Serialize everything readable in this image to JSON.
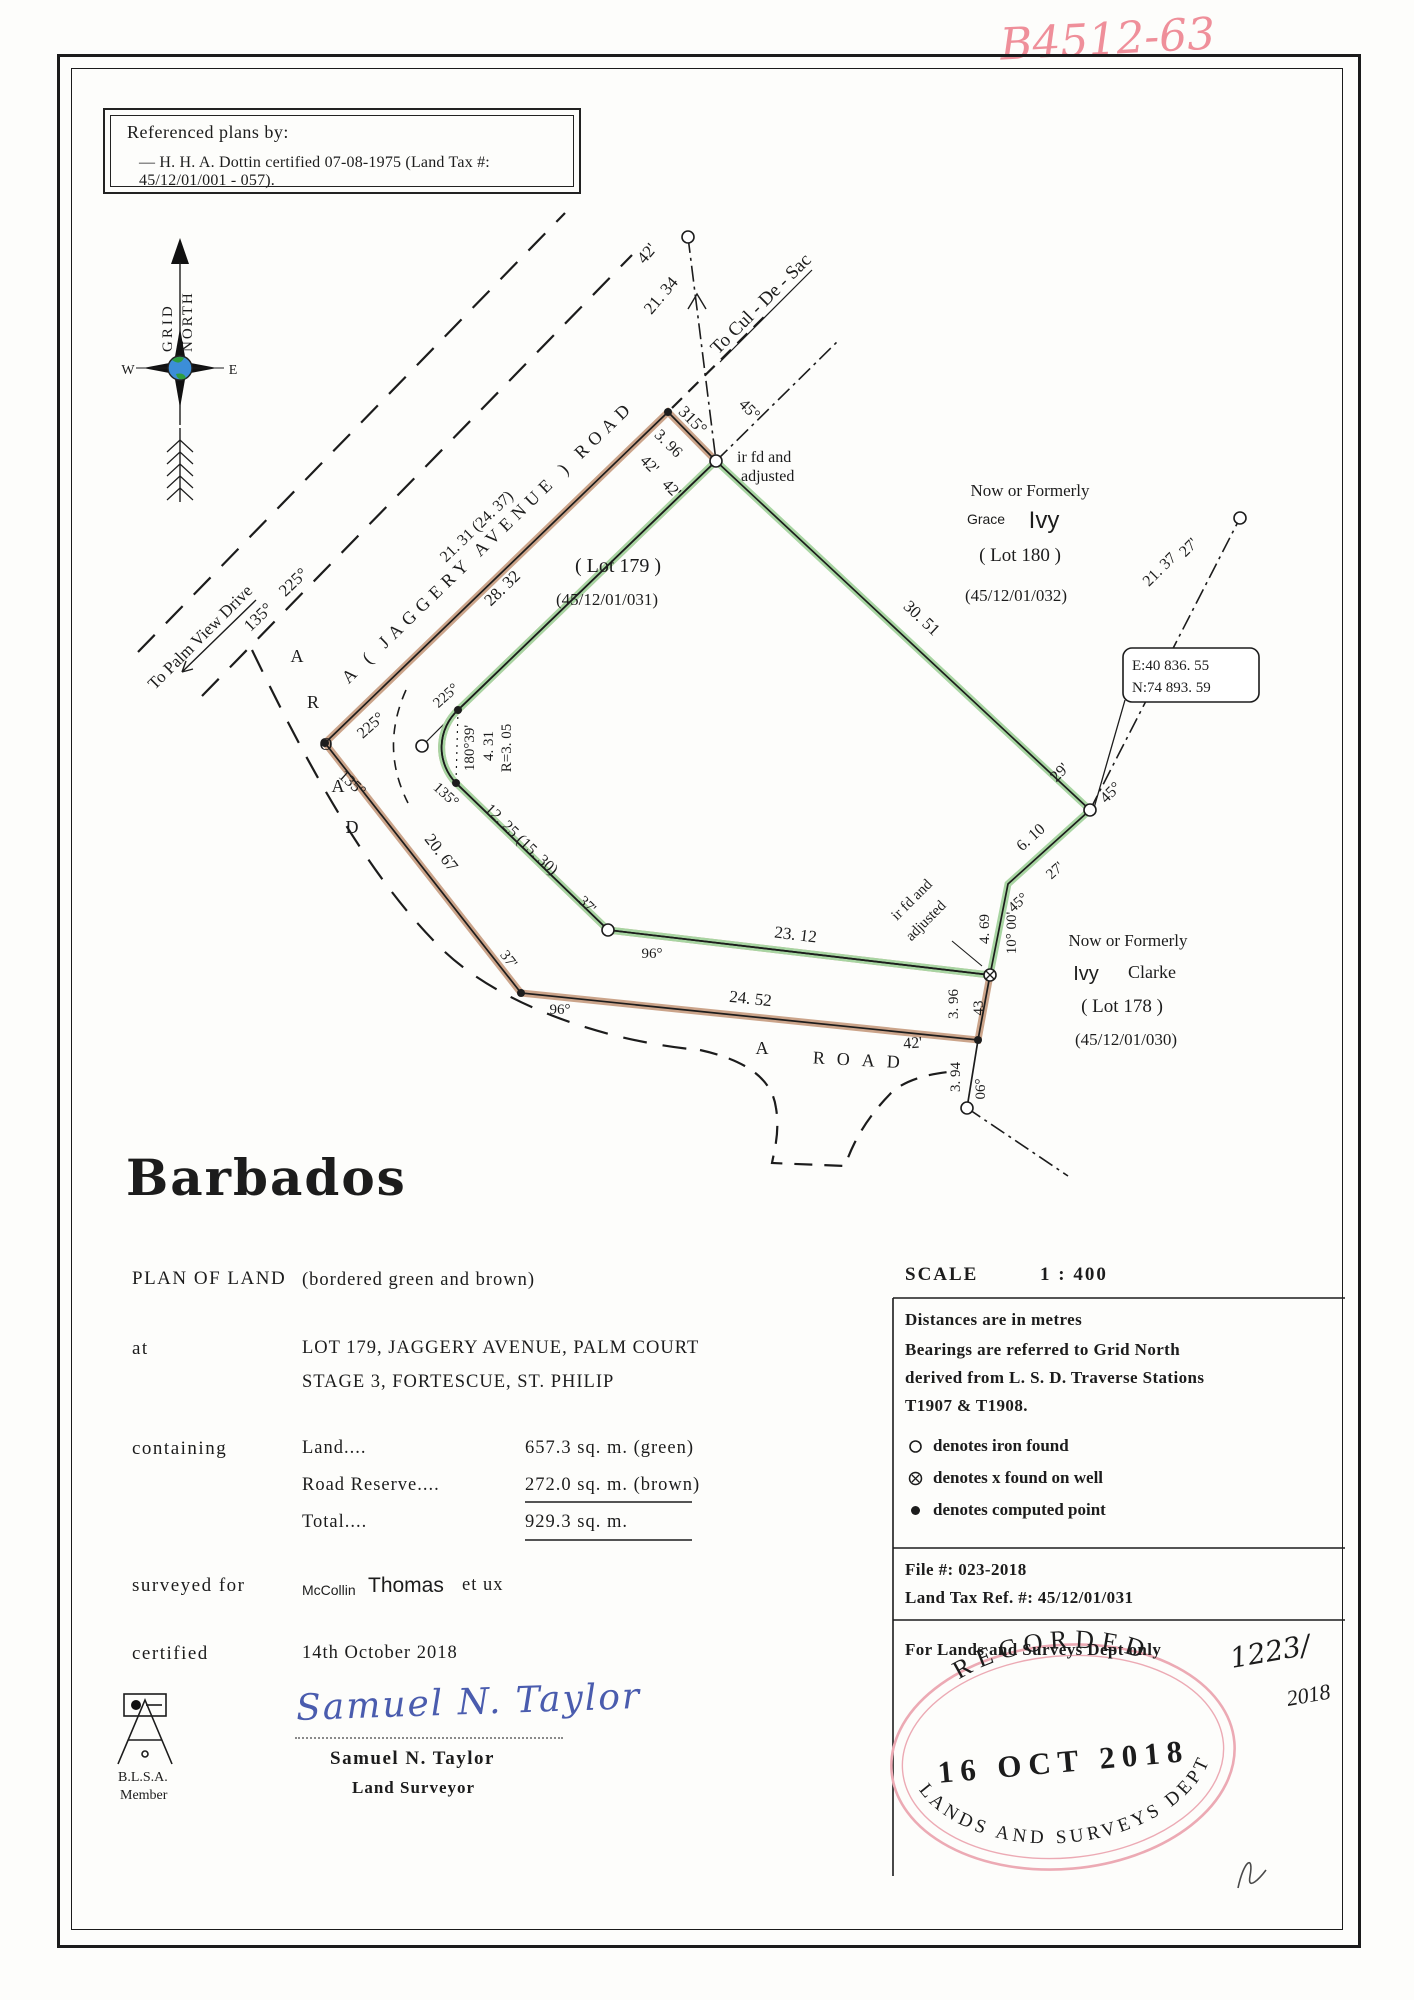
{
  "page": {
    "handwritten_ref": "B4512-63"
  },
  "referenced_plans": {
    "title": "Referenced plans by:",
    "item": "—   H. H. A. Dottin certified 07-08-1975 (Land Tax #: 45/12/01/001 - 057)."
  },
  "compass": {
    "grid": "GRID",
    "north": "NORTH",
    "w": "W",
    "e": "E"
  },
  "plan": {
    "coord_box": {
      "e": "E:40  836. 55",
      "n": "N:74  893. 59"
    },
    "labels": [
      {
        "t": "To Cul - De - Sac",
        "x": 765,
        "y": 308,
        "r": -45,
        "fs": 19
      },
      {
        "t": "42'",
        "x": 651,
        "y": 257,
        "r": -50,
        "fs": 17
      },
      {
        "t": "21. 34",
        "x": 665,
        "y": 299,
        "r": -50,
        "fs": 17
      },
      {
        "t": "45°",
        "x": 746,
        "y": 413,
        "r": 45,
        "fs": 16
      },
      {
        "t": "315°",
        "x": 689,
        "y": 424,
        "r": 45,
        "fs": 17
      },
      {
        "t": "3. 96",
        "x": 665,
        "y": 447,
        "r": 45,
        "fs": 16
      },
      {
        "t": "42'",
        "x": 646,
        "y": 468,
        "r": 45,
        "fs": 16
      },
      {
        "t": "42'",
        "x": 668,
        "y": 492,
        "r": 45,
        "fs": 16
      },
      {
        "t": "ir fd and",
        "x": 737,
        "y": 462,
        "r": 0,
        "fs": 16,
        "a": "start"
      },
      {
        "t": "adjusted",
        "x": 741,
        "y": 481,
        "r": 0,
        "fs": 16,
        "a": "start"
      },
      {
        "t": "Now or Formerly",
        "x": 1030,
        "y": 496,
        "r": 0,
        "fs": 17
      },
      {
        "t": "Grace",
        "x": 986,
        "y": 524,
        "r": 0,
        "fs": 14,
        "f": "sans"
      },
      {
        "t": "Ivy",
        "x": 1044,
        "y": 528,
        "r": 0,
        "fs": 24,
        "f": "sans"
      },
      {
        "t": "( Lot 180 )",
        "x": 1020,
        "y": 561,
        "r": 0,
        "fs": 19
      },
      {
        "t": "(45/12/01/032)",
        "x": 1016,
        "y": 601,
        "r": 0,
        "fs": 17
      },
      {
        "t": "A   ( JAGGERY  AVENUE )  ROAD",
        "x": 492,
        "y": 546,
        "r": -44,
        "fs": 18,
        "ls": 6
      },
      {
        "t": "28. 32",
        "x": 506,
        "y": 592,
        "r": -44,
        "fs": 17
      },
      {
        "t": "225°",
        "x": 297,
        "y": 586,
        "r": -44,
        "fs": 17
      },
      {
        "t": "135°",
        "x": 262,
        "y": 621,
        "r": -44,
        "fs": 17
      },
      {
        "t": "To Palm View Drive",
        "x": 204,
        "y": 641,
        "r": -45,
        "fs": 17
      },
      {
        "t": "225°",
        "x": 374,
        "y": 729,
        "r": -42,
        "fs": 16
      },
      {
        "t": "135°",
        "x": 349,
        "y": 787,
        "r": 42,
        "fs": 16
      },
      {
        "t": "A",
        "x": 297,
        "y": 662,
        "r": 0,
        "fs": 18
      },
      {
        "t": "R",
        "x": 313,
        "y": 708,
        "r": 0,
        "fs": 18
      },
      {
        "t": "O",
        "x": 326,
        "y": 750,
        "r": 0,
        "fs": 18
      },
      {
        "t": "A",
        "x": 338,
        "y": 792,
        "r": 0,
        "fs": 18
      },
      {
        "t": "D",
        "x": 352,
        "y": 833,
        "r": 0,
        "fs": 18
      },
      {
        "t": "20. 67",
        "x": 437,
        "y": 856,
        "r": 52,
        "fs": 17
      },
      {
        "t": "225°",
        "x": 449,
        "y": 699,
        "r": -42,
        "fs": 15
      },
      {
        "t": "135°",
        "x": 443,
        "y": 798,
        "r": 42,
        "fs": 15
      },
      {
        "t": "180°39'",
        "x": 474,
        "y": 748,
        "r": -90,
        "fs": 15
      },
      {
        "t": "4. 31",
        "x": 493,
        "y": 746,
        "r": -90,
        "fs": 15
      },
      {
        "t": "R=3. 05",
        "x": 511,
        "y": 748,
        "r": -90,
        "fs": 15
      },
      {
        "t": "21. 31  (24. 37)",
        "x": 480,
        "y": 530,
        "r": -44,
        "fs": 16
      },
      {
        "t": "12. 25  (15. 30)",
        "x": 518,
        "y": 843,
        "r": 44,
        "fs": 16
      },
      {
        "t": "( Lot 179 )",
        "x": 618,
        "y": 572,
        "r": 0,
        "fs": 20
      },
      {
        "t": "(45/12/01/031)",
        "x": 607,
        "y": 605,
        "r": 0,
        "fs": 17
      },
      {
        "t": "30. 51",
        "x": 918,
        "y": 622,
        "r": 43,
        "fs": 17
      },
      {
        "t": "29'",
        "x": 1063,
        "y": 776,
        "r": -45,
        "fs": 16
      },
      {
        "t": "45°",
        "x": 1114,
        "y": 796,
        "r": -45,
        "fs": 16
      },
      {
        "t": "21. 37",
        "x": 1163,
        "y": 573,
        "r": -45,
        "fs": 16
      },
      {
        "t": "27'",
        "x": 1192,
        "y": 551,
        "r": -45,
        "fs": 16
      },
      {
        "t": "6. 10",
        "x": 1034,
        "y": 841,
        "r": -42,
        "fs": 16
      },
      {
        "t": "27'",
        "x": 1058,
        "y": 874,
        "r": -42,
        "fs": 15
      },
      {
        "t": "45°",
        "x": 1021,
        "y": 906,
        "r": -42,
        "fs": 15
      },
      {
        "t": "10° 00'",
        "x": 1016,
        "y": 933,
        "r": -90,
        "fs": 15
      },
      {
        "t": "4. 69",
        "x": 989,
        "y": 929,
        "r": -90,
        "fs": 15
      },
      {
        "t": "ir fd and",
        "x": 915,
        "y": 903,
        "r": -45,
        "fs": 15
      },
      {
        "t": "adjusted",
        "x": 929,
        "y": 924,
        "r": -45,
        "fs": 15
      },
      {
        "t": "Now or Formerly",
        "x": 1128,
        "y": 946,
        "r": 0,
        "fs": 17
      },
      {
        "t": "Ivy",
        "x": 1086,
        "y": 980,
        "r": 0,
        "fs": 20,
        "f": "sans"
      },
      {
        "t": "Clarke",
        "x": 1152,
        "y": 978,
        "r": 0,
        "fs": 18
      },
      {
        "t": "( Lot 178 )",
        "x": 1122,
        "y": 1012,
        "r": 0,
        "fs": 19
      },
      {
        "t": "(45/12/01/030)",
        "x": 1126,
        "y": 1045,
        "r": 0,
        "fs": 17
      },
      {
        "t": "23. 12",
        "x": 795,
        "y": 940,
        "r": 7,
        "fs": 17
      },
      {
        "t": "37'",
        "x": 584,
        "y": 908,
        "r": 44,
        "fs": 15
      },
      {
        "t": "96°",
        "x": 652,
        "y": 958,
        "r": 0,
        "fs": 15
      },
      {
        "t": "24. 52",
        "x": 750,
        "y": 1004,
        "r": 6,
        "fs": 17
      },
      {
        "t": "37'",
        "x": 505,
        "y": 962,
        "r": 52,
        "fs": 15
      },
      {
        "t": "96°",
        "x": 560,
        "y": 1014,
        "r": 0,
        "fs": 15
      },
      {
        "t": "42'",
        "x": 913,
        "y": 1048,
        "r": -4,
        "fs": 16
      },
      {
        "t": "3. 96",
        "x": 958,
        "y": 1004,
        "r": -90,
        "fs": 15
      },
      {
        "t": "43",
        "x": 983,
        "y": 1008,
        "r": -90,
        "fs": 15
      },
      {
        "t": "3. 94",
        "x": 960,
        "y": 1077,
        "r": -90,
        "fs": 15
      },
      {
        "t": "06°",
        "x": 985,
        "y": 1089,
        "r": -90,
        "fs": 15
      },
      {
        "t": "A",
        "x": 762,
        "y": 1054,
        "r": 0,
        "fs": 18
      },
      {
        "t": "ROAD",
        "x": 862,
        "y": 1066,
        "r": 3,
        "fs": 18,
        "ls": 12
      }
    ],
    "markers": [
      {
        "k": "dot",
        "x": 668,
        "y": 412
      },
      {
        "k": "circ",
        "x": 716,
        "y": 461
      },
      {
        "k": "circ",
        "x": 1090,
        "y": 810
      },
      {
        "k": "xwell",
        "x": 990,
        "y": 975
      },
      {
        "k": "dot",
        "x": 978,
        "y": 1040
      },
      {
        "k": "circ",
        "x": 967,
        "y": 1108
      },
      {
        "k": "circ",
        "x": 608,
        "y": 930
      },
      {
        "k": "dot",
        "x": 521,
        "y": 993
      },
      {
        "k": "dot",
        "x": 325,
        "y": 743
      },
      {
        "k": "dot",
        "x": 458,
        "y": 710
      },
      {
        "k": "dot",
        "x": 456,
        "y": 783
      },
      {
        "k": "circ",
        "x": 422,
        "y": 746
      },
      {
        "k": "circ",
        "x": 688,
        "y": 237
      },
      {
        "k": "circ",
        "x": 1240,
        "y": 518
      }
    ]
  },
  "title_block": {
    "country": "Barbados",
    "plan_of_land": "PLAN  OF  LAND",
    "bordered": "(bordered  green  and  brown)",
    "at_label": "at",
    "at_line1": "LOT  179,  JAGGERY  AVENUE,  PALM  COURT",
    "at_line2": "STAGE  3,  FORTESCUE,  ST.  PHILIP",
    "containing_label": "containing",
    "rows": [
      {
        "name": "Land....",
        "value": "657.3  sq.  m.  (green)"
      },
      {
        "name": "Road  Reserve....",
        "value": "272.0  sq.  m.  (brown)"
      },
      {
        "name": "Total....",
        "value": "929.3  sq.  m."
      }
    ],
    "surveyed_label": "surveyed  for",
    "surveyed_name_small": "McCollin",
    "surveyed_name": "Thomas",
    "surveyed_suffix": "et  ux",
    "certified_label": "certified",
    "certified_date": "14th  October  2018",
    "signature": "Samuel  N.  Taylor",
    "surveyor_name": "Samuel  N.  Taylor",
    "surveyor_title": "Land  Surveyor",
    "blsa_line1": "B.L.S.A.",
    "blsa_line2": "Member"
  },
  "notes_block": {
    "scale_label": "SCALE",
    "scale_value": "1  :  400",
    "note1": "Distances  are  in  metres",
    "note2a": "Bearings  are  referred  to  Grid  North",
    "note2b": "derived  from  L. S. D.  Traverse  Stations",
    "note2c": "T1907  &  T1908.",
    "legend": [
      {
        "sym": "iron-found-circle",
        "text": "denotes  iron  found"
      },
      {
        "sym": "x-on-well-circle",
        "text": "denotes  x  found  on  well"
      },
      {
        "sym": "computed-point-dot",
        "text": "denotes  computed  point"
      }
    ],
    "file_no": "File  #:  023-2018",
    "land_tax": "Land  Tax  Ref.  #:  45/12/01/031",
    "dept_only": "For  Lands  and  Surveys  Dept  only",
    "handwritten_no1": "1223/",
    "handwritten_no2": "2018",
    "stamp": {
      "top": "RECORDED",
      "date": "16  OCT  2018",
      "bottom": "LANDS AND SURVEYS DEPT"
    }
  }
}
